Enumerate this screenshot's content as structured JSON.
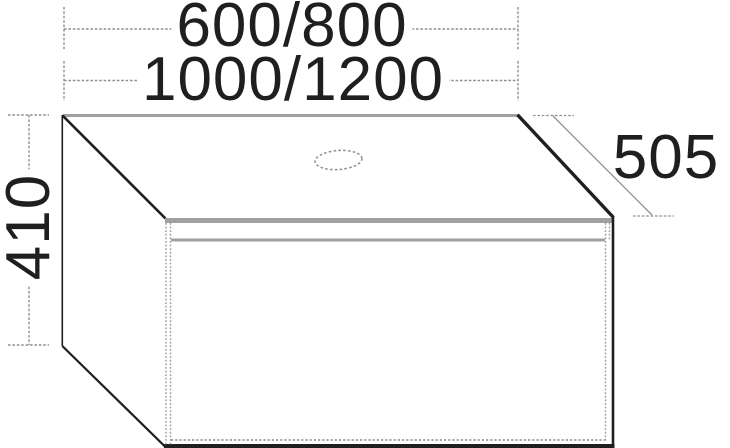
{
  "diagram": {
    "dimensions": {
      "width_top": "600/800",
      "width_bottom": "1000/1200",
      "height": "410",
      "depth": "505"
    },
    "colors": {
      "edge": "#1f1f1f",
      "secondary_edge": "#a0a0a0",
      "dimension_line": "#8f8f8f",
      "background": "#ffffff"
    }
  }
}
